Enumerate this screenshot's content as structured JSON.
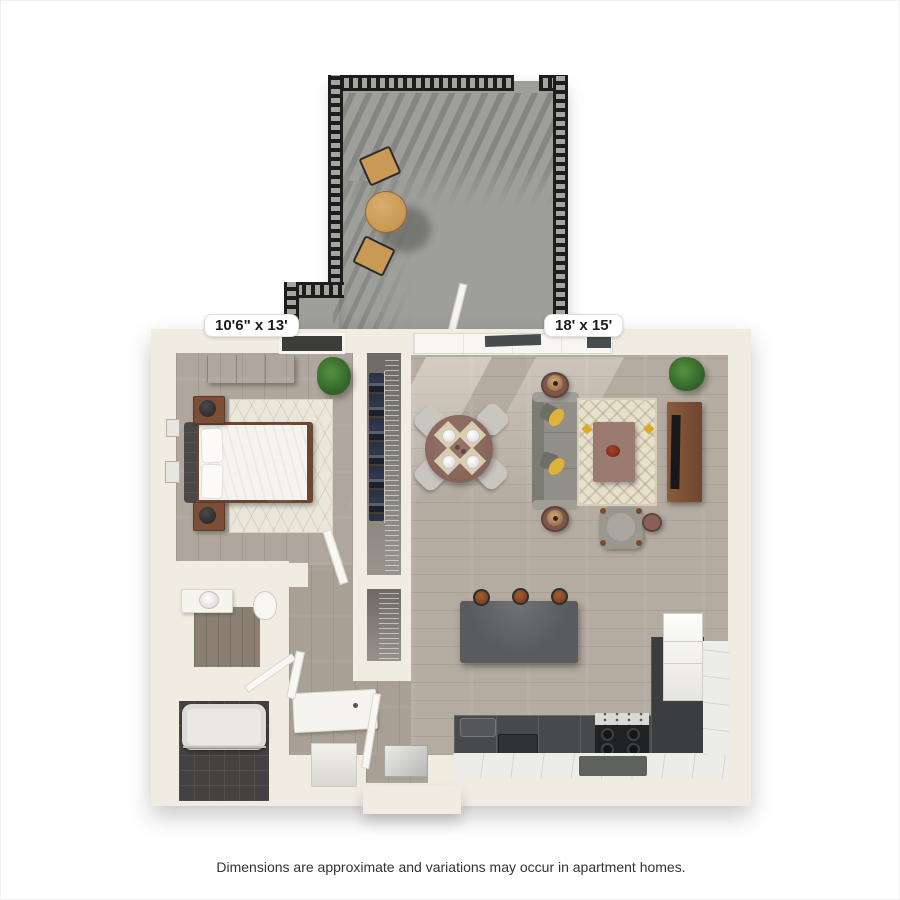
{
  "title": "apartment-floor-plan",
  "labels": {
    "bedroom": "10'6\" x 13'",
    "living": "18' x 15'"
  },
  "footer": {
    "disclaimer": "Dimensions are approximate and variations may occur in apartment homes."
  },
  "palette": {
    "background": "#ffffff",
    "wall": "#f0ece1",
    "wood_floor": "#b2a9a0",
    "balcony_floor": "#9e9e9a",
    "railing": "#1d1d1d",
    "kitchen_counter": "#47494b",
    "kitchen_island": "#595b5d",
    "light_tile": "#ececea",
    "bath_tile": "#434240",
    "sofa": "#928f88",
    "accent_pillow": "#e0b23c",
    "wood_furniture": "#7c4e36",
    "table_mauve": "#8b6a5f",
    "rug_cream": "#e7e0cb",
    "plant_green": "#3c7a33"
  }
}
